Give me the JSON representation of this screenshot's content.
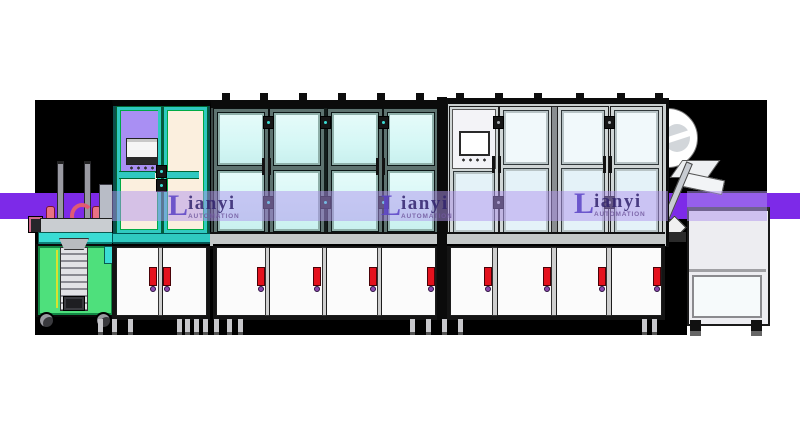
{
  "watermark": {
    "brand_initial": "L",
    "brand_rest": "ianyi",
    "subtitle": "AUTOMATION",
    "logo_count": 3
  },
  "colors": {
    "page_bg": "#FFFFFF",
    "backdrop": "#000000",
    "band_purple": "#7D2AE8",
    "watermark_lavender": "rgba(176,148,238,0.5)",
    "logo_indigo": "#32246E",
    "logo_initial_purple": "#5B43C6",
    "logo_subtitle": "#71589E",
    "teal_frame": "#2FC9C0",
    "teal_frame_dark": "#0B4F4B",
    "glass_cyan": "#D5F7F5",
    "cream_panel": "#FBEFDE",
    "purple_panel": "#A98FF3",
    "machine_green": "#4EE07C",
    "handle_red": "#E4121E",
    "screw_purple": "#8A4AAE",
    "frame_gray": "#C9CECE",
    "glass_white": "#F1F9FB",
    "glass_blue": "#E4F2F8",
    "cabinet_white": "#FBFBFB",
    "sill_gray": "#C4C8C8",
    "dark_frame": "#0D0D0D",
    "page_white": "#FFFFFF"
  }
}
